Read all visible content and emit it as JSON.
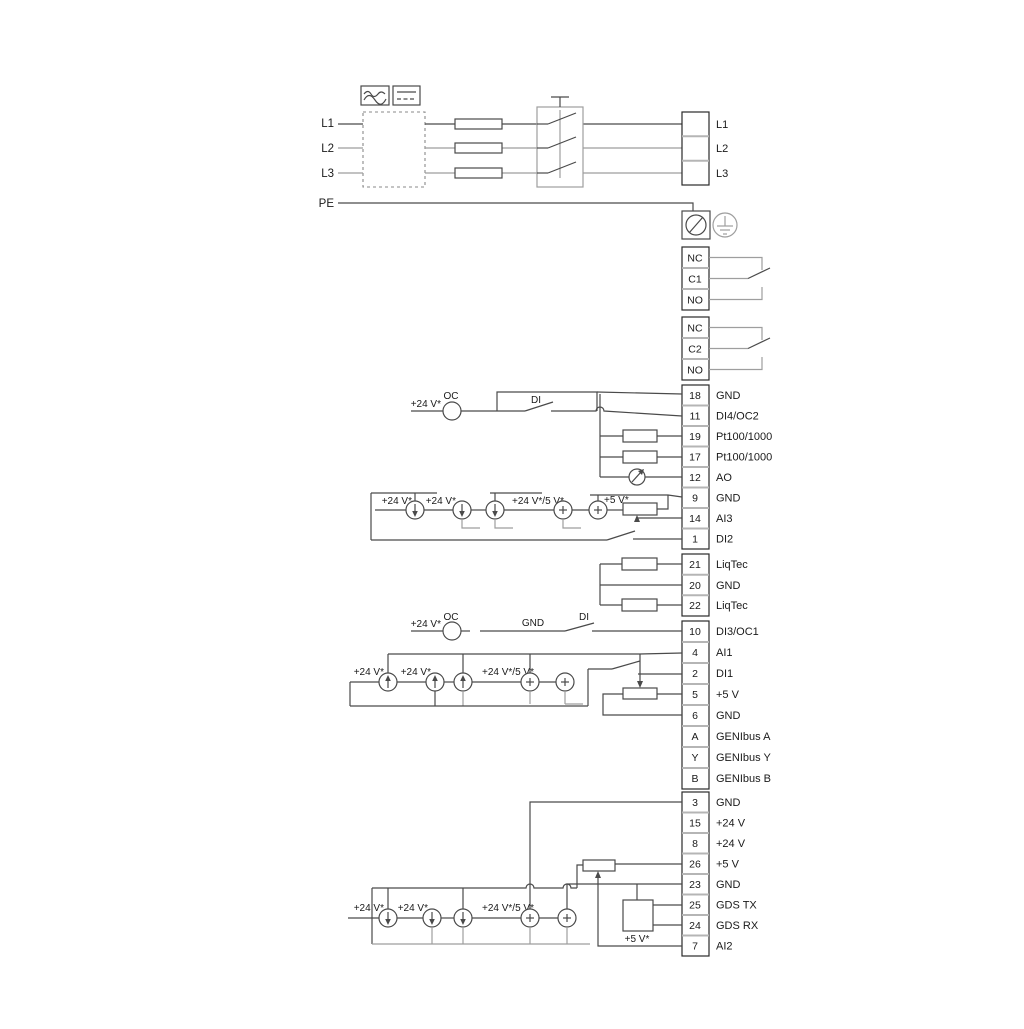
{
  "colors": {
    "wire": "#4a4a4a",
    "light_wire": "#9e9e9e",
    "ink": "#1a1a1a",
    "background": "#ffffff"
  },
  "mains": {
    "inputs": [
      "L1",
      "L2",
      "L3",
      "PE"
    ],
    "outputs": [
      "L1",
      "L2",
      "L3"
    ]
  },
  "relays": {
    "relay1": [
      "NC",
      "C1",
      "NO"
    ],
    "relay2": [
      "NC",
      "C2",
      "NO"
    ]
  },
  "terminal_groups": {
    "io1": [
      {
        "n": "18",
        "label": "GND"
      },
      {
        "n": "11",
        "label": "DI4/OC2"
      },
      {
        "n": "19",
        "label": "Pt100/1000"
      },
      {
        "n": "17",
        "label": "Pt100/1000"
      },
      {
        "n": "12",
        "label": "AO"
      },
      {
        "n": "9",
        "label": "GND"
      },
      {
        "n": "14",
        "label": "AI3"
      },
      {
        "n": "1",
        "label": "DI2"
      }
    ],
    "liqtec": [
      {
        "n": "21",
        "label": "LiqTec"
      },
      {
        "n": "20",
        "label": "GND"
      },
      {
        "n": "22",
        "label": "LiqTec"
      }
    ],
    "io2": [
      {
        "n": "10",
        "label": "DI3/OC1"
      },
      {
        "n": "4",
        "label": "AI1"
      },
      {
        "n": "2",
        "label": "DI1"
      },
      {
        "n": "5",
        "label": "+5 V"
      },
      {
        "n": "6",
        "label": "GND"
      },
      {
        "n": "A",
        "label": "GENIbus A"
      },
      {
        "n": "Y",
        "label": "GENIbus Y"
      },
      {
        "n": "B",
        "label": "GENIbus B"
      }
    ],
    "io3": [
      {
        "n": "3",
        "label": "GND"
      },
      {
        "n": "15",
        "label": "+24 V"
      },
      {
        "n": "8",
        "label": "+24 V"
      },
      {
        "n": "26",
        "label": "+5 V"
      },
      {
        "n": "23",
        "label": "GND"
      },
      {
        "n": "25",
        "label": "GDS TX"
      },
      {
        "n": "24",
        "label": "GDS RX"
      },
      {
        "n": "7",
        "label": "AI2"
      }
    ]
  },
  "annotations": {
    "v24": "+24 V*",
    "v24_5": "+24 V*/5 V*",
    "v5": "+5 V*",
    "oc": "OC",
    "di": "DI",
    "gnd": "GND"
  }
}
